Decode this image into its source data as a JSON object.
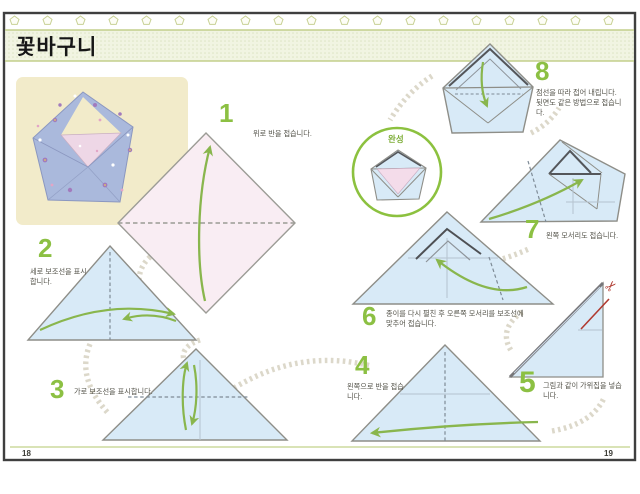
{
  "page": {
    "title": "꽃바구니",
    "page_number_left": "18",
    "page_number_right": "19"
  },
  "completion": {
    "label": "완성"
  },
  "steps": [
    {
      "number": "1",
      "caption": "위로 반을 접습니다."
    },
    {
      "number": "2",
      "caption": "세로 보조선을 표시합니다."
    },
    {
      "number": "3",
      "caption": "가로 보조선을 표시합니다."
    },
    {
      "number": "4",
      "caption": "왼쪽으로 반을 접습니다."
    },
    {
      "number": "5",
      "caption": "그림과 같이 가위집을 넣습니다."
    },
    {
      "number": "6",
      "caption": "종이를 다시 펼친 후 오른쪽 모서리를 보조선에 맞추어 접습니다."
    },
    {
      "number": "7",
      "caption": "왼쪽 모서리도 접습니다."
    },
    {
      "number": "8",
      "caption": "점선을 따라 접어 내립니다. 뒷면도 같은 방법으로 접습니다."
    }
  ],
  "icons": {
    "scissors": "✂"
  },
  "colors": {
    "accent_green": "#8cc043",
    "paper_blue": "#d8eaf7",
    "paper_pink": "#f9edf3",
    "arrow_green": "#89b64d",
    "cut_red": "#b03a30",
    "band_green": "#c3cf8b",
    "trail_gray": "#dcd8ca"
  }
}
